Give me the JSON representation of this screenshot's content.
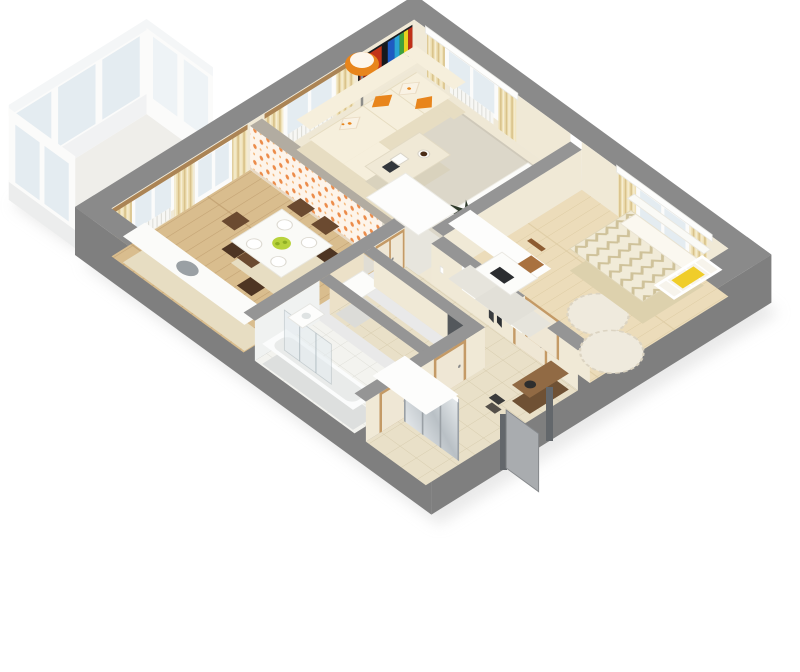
{
  "scene": {
    "type": "isometric-3d-floor-plan-render",
    "description": "cutaway 3D render of a one-bedroom apartment viewed from above at an angle",
    "background": "#ffffff"
  },
  "colors": {
    "background": "#ffffff",
    "shadow": "#d8d8d8",
    "wall_top_outer": "#8a8a8a",
    "wall_side": "#7f7f7f",
    "wall_top_inner": "#959595",
    "granite_top": "#b2aca1",
    "wall_face": "#f0e9d6",
    "wall_face_shade": "#e6dcc3",
    "floor_kitchen": "#d9bd8e",
    "floor_kitchen_line": "#c3a273",
    "floor_living": "#efe8d5",
    "rug": "#dcd7c9",
    "floor_bedroom": "#ecdcba",
    "floor_bedroom_line": "#ddcba2",
    "tile_beige": "#e9e0c8",
    "tile_beige_line": "#d7ccae",
    "tile_white": "#f3f3ef",
    "tile_white_line": "#dfdfd8",
    "curtain": "#eee0b5",
    "curtain_pleat": "#d9c28a",
    "curtain_rod": "#ab8455",
    "glass": "#e4ecf1",
    "frame_white": "#fbfbfa",
    "sofa": "#f6efdc",
    "sofa_shade": "#e7ddc2",
    "accent_orange": "#e8851c",
    "painting_red": "#c23418",
    "painting_blue": "#1f5ac2",
    "door_wood": "#c49a66",
    "door_leaf": "#efe7d5",
    "door_jamb": "#a87c4e",
    "mirror": "#c7ccd1",
    "tub_white": "#fbfcfc",
    "panel_dark": "#54585c",
    "crib_yellow": "#f0cd2a",
    "plant_dark": "#2f3a2b",
    "greenery": "#4e7a3a",
    "bowl_green": "#b8d23c",
    "chair_wood_dark": "#6b4a30",
    "chair_wood_light": "#a9713f",
    "entrance_door": "#a9acaf",
    "radiator": "#f7f7f4",
    "wallpaper_bg": "#fdf4ea",
    "wallpaper_dot": "#ec8c4a",
    "pastel_bg": "#fdfdfb",
    "pastel_teal": "#8fd4cf",
    "pastel_yellow": "#f2d46a",
    "chevron_bg": "#f1ebd8",
    "chevron_line": "#cfc29a",
    "white": "#ffffff"
  },
  "rooms": [
    {
      "name": "balcony",
      "items": [
        "glazed window wall",
        "white frames"
      ]
    },
    {
      "name": "kitchen-dining",
      "items": [
        "kitchen counter",
        "sink",
        "fridge",
        "dining table",
        "plates",
        "fruit bowl",
        "dining chairs",
        "orange floral wallpaper",
        "balcony door",
        "window",
        "curtains",
        "radiator"
      ]
    },
    {
      "name": "living-room",
      "items": [
        "corner sofa",
        "orange pillows",
        "floral pillows",
        "floor lamp",
        "abstract painting",
        "coffee table",
        "area rug",
        "tv cabinet",
        "potted plant",
        "two windows",
        "curtains"
      ]
    },
    {
      "name": "bedroom",
      "items": [
        "double bed",
        "chevron duvet",
        "baby crib",
        "desk",
        "laptop",
        "chair",
        "wardrobe",
        "round rugs",
        "window",
        "curtains",
        "radiator",
        "polka-dot accent wall"
      ]
    },
    {
      "name": "bathroom",
      "items": [
        "bathtub",
        "glass shower screen",
        "sink",
        "dark wall panel"
      ]
    },
    {
      "name": "toilet",
      "items": [
        "washing machine"
      ]
    },
    {
      "name": "hallway",
      "items": [
        "wooden doors",
        "coat hooks",
        "wall shelf"
      ]
    },
    {
      "name": "entrance-hall",
      "items": [
        "sliding mirror wardrobe",
        "shoe bench",
        "entrance door",
        "tiled floor"
      ]
    }
  ]
}
